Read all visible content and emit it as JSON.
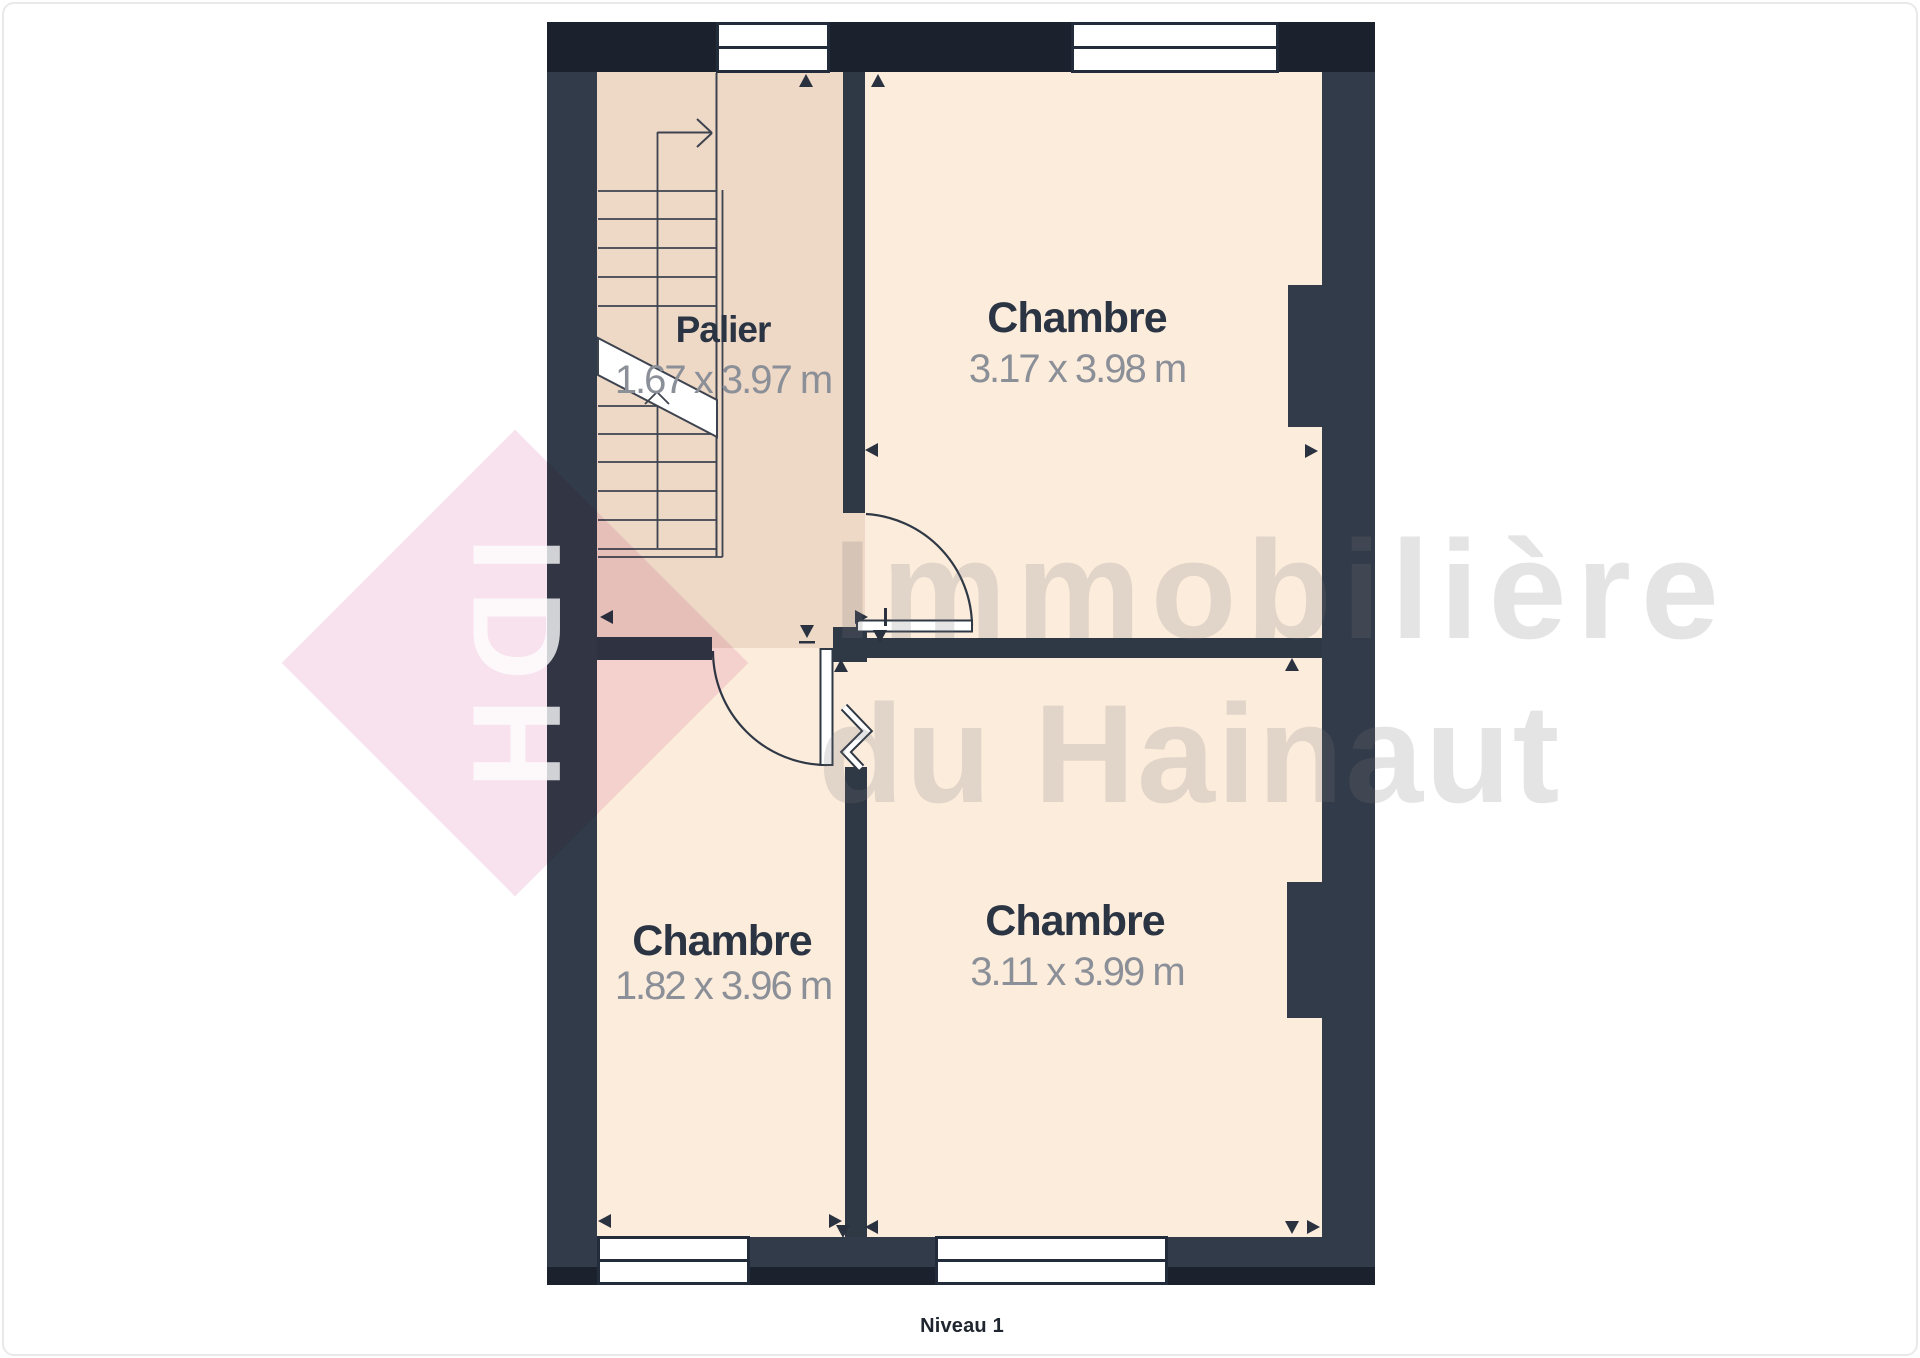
{
  "page": {
    "caption": "Niveau 1"
  },
  "watermark": {
    "logo": "IDH",
    "line1": "Immobilière",
    "line2": "du Hainaut"
  },
  "rooms": [
    {
      "name": "Palier",
      "dims": "1.67 x 3.97 m"
    },
    {
      "name": "Chambre",
      "dims": "3.17 x 3.98 m"
    },
    {
      "name": "Chambre",
      "dims": "1.82 x 3.96 m"
    },
    {
      "name": "Chambre",
      "dims": "3.11 x 3.99 m"
    }
  ],
  "colors": {
    "wall_dark": "#1b222e",
    "wall": "#323b49",
    "wall_inner": "#2f3845",
    "floor_palier": "#eed8c6",
    "floor_room": "#fcecdc",
    "line": "#3d434f",
    "room_label": "#2b3442",
    "room_dims": "#8b8f97",
    "marker": "#2a3240",
    "wm_pink": "#f7e2ee",
    "wm_text": "rgba(120,120,120,0.20)",
    "wm_logo": "rgba(255,255,255,0.78)",
    "caption_color": "#20262f",
    "page_border": "#e9e9e9"
  }
}
